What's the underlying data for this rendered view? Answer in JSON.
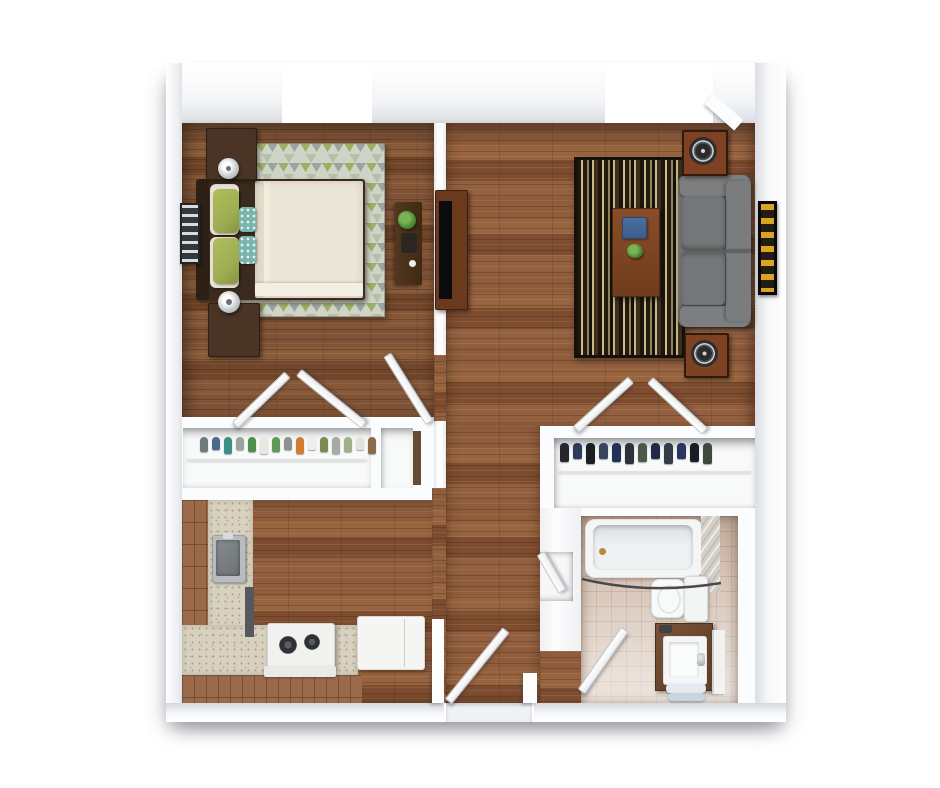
{
  "meta": {
    "description": "Photorealistic 3D top-down floor plan render of a one-bedroom apartment",
    "view": "top-down 3D dollhouse"
  },
  "palette": {
    "wall": "#fbfcfd",
    "wood_main": "#8a573a",
    "wood_bed": "#7c5134",
    "counter": "#d8d1bf",
    "cabinet": "#9a6a4a",
    "tile_floor": "#d6c3b5",
    "rug_base": "#ced4c6",
    "rug_olive": "#9fae66",
    "rug_sage": "#b6c0a8",
    "rug_gray": "#9aa59e",
    "stripe_dark": "#1c150c",
    "stripe_tan": "#cdbb8a",
    "sofa": "#6e7072",
    "sofa_light": "#7c7e80",
    "furniture_wood": "#5a3a24",
    "tv_black": "#0c0c0e",
    "laptop": "#3a5f8e",
    "plant": "#4e8a38",
    "metal": "#c9cdd1",
    "lamp": "#d8dbdf",
    "tub_white": "#f4f6f6",
    "duvet": "#ece6d8",
    "pillow_green": "#9fae52",
    "pillow_teal": "#7ab4ac",
    "frame_dark": "#3a2b1e",
    "towel_a": "#e4eaef",
    "towel_b": "#c9d6e0",
    "art_accent_yellow": "#d8a51f"
  },
  "rooms": {
    "bedroom": {
      "furniture": [
        "double bed",
        "headboard",
        "green and teal accent pillows",
        "triangle-pattern area rug",
        "nightstand with lamp (top)",
        "nightstand with lamp (bottom)",
        "desk with plant",
        "louvered wall art",
        "window"
      ]
    },
    "living_room": {
      "furniture": [
        "gray sofa",
        "striped area rug",
        "wood coffee table",
        "blue laptop",
        "small plant",
        "speaker (top)",
        "speaker (bottom)",
        "tv console with tv",
        "framed wall art",
        "window",
        "corner bulkhead"
      ]
    },
    "kitchen": {
      "furniture": [
        "L-shaped counter with cabinets",
        "stainless sink",
        "dishwasher front",
        "stove with two burners",
        "refrigerator"
      ]
    },
    "bathroom": {
      "furniture": [
        "bathtub",
        "shower curtain rod",
        "tiled shower wall",
        "toilet",
        "wood vanity with sink",
        "stacked towels",
        "mirror panel",
        "door"
      ]
    },
    "bedroom_closet": {
      "garment_colors": [
        "#6d7a7c",
        "#4a6a8c",
        "#3f8d84",
        "#9aa39c",
        "#4f8f4d",
        "#e9e7e0",
        "#5d9a58",
        "#8d938c",
        "#d07c33",
        "#efeeea",
        "#7b8a50",
        "#a9aaa2",
        "#9fb08a",
        "#e4e2da",
        "#8a6a4a"
      ]
    },
    "hall_closet": {
      "garment_colors": [
        "#23262e",
        "#2c3a5e",
        "#1b1e24",
        "#39455c",
        "#233057",
        "#2e3136",
        "#4e584a",
        "#1f2a4a",
        "#343c48",
        "#2a3560",
        "#191c22",
        "#3e4a3e"
      ]
    },
    "hallway": {
      "furniture": [
        "open doorways with swinging doors"
      ]
    },
    "entry": {
      "furniture": [
        "entry door",
        "threshold"
      ]
    },
    "linen_niche": {
      "furniture": [
        "small niche with door"
      ]
    }
  }
}
